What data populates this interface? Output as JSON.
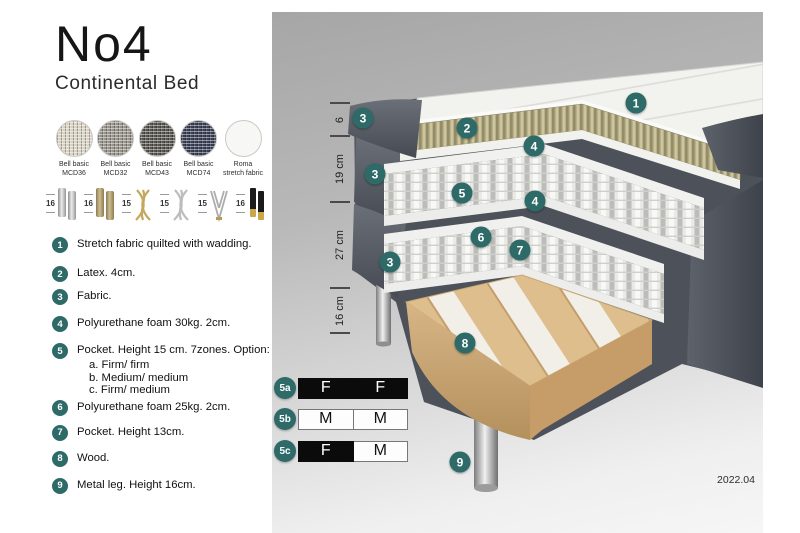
{
  "product": {
    "title": "No4",
    "subtitle": "Continental Bed"
  },
  "fabric_swatches": [
    {
      "line1": "Bell basic",
      "line2": "MCD36",
      "base": "#d8d2c2",
      "type": "woven"
    },
    {
      "line1": "Bell basic",
      "line2": "MCD32",
      "base": "#97938a",
      "type": "woven"
    },
    {
      "line1": "Bell basic",
      "line2": "MCD43",
      "base": "#56544f",
      "type": "woven"
    },
    {
      "line1": "Bell basic",
      "line2": "MCD74",
      "base": "#3a3e54",
      "type": "woven"
    },
    {
      "line1": "Roma",
      "line2": "stretch fabric",
      "base": "#f7f7f5",
      "type": "plain"
    }
  ],
  "leg_options": [
    {
      "height": "16",
      "style": "chrome-cylinder"
    },
    {
      "height": "16",
      "style": "brass-cylinder"
    },
    {
      "height": "15",
      "style": "gold-twisted"
    },
    {
      "height": "15",
      "style": "silver-twisted"
    },
    {
      "height": "15",
      "style": "hairpin"
    },
    {
      "height": "16",
      "style": "black-gold"
    }
  ],
  "spec_list": [
    {
      "num": "1",
      "text": "Stretch fabric quilted with wadding.",
      "options": []
    },
    {
      "num": "2",
      "text": "Latex. 4cm.",
      "options": []
    },
    {
      "num": "3",
      "text": "Fabric.",
      "options": []
    },
    {
      "num": "4",
      "text": "Polyurethane foam 30kg. 2cm.",
      "options": []
    },
    {
      "num": "5",
      "text": "Pocket. Height 15 cm. 7zones. Option:",
      "options": [
        "a. Firm/ firm",
        "b. Medium/ medium",
        "c. Firm/ medium"
      ]
    },
    {
      "num": "6",
      "text": "Polyurethane foam 25kg. 2cm.",
      "options": []
    },
    {
      "num": "7",
      "text": "Pocket. Height 13cm.",
      "options": []
    },
    {
      "num": "8",
      "text": "Wood.",
      "options": []
    },
    {
      "num": "9",
      "text": "Metal leg. Height 16cm.",
      "options": []
    }
  ],
  "diagram": {
    "dimension_segments": [
      {
        "label": "6",
        "from": 91,
        "to": 124
      },
      {
        "label": "19 cm",
        "from": 124,
        "to": 190
      },
      {
        "label": "27 cm",
        "from": 190,
        "to": 276
      },
      {
        "label": "16 cm",
        "from": 276,
        "to": 321
      }
    ],
    "callouts": [
      {
        "label": "1",
        "x": 364,
        "y": 91
      },
      {
        "label": "2",
        "x": 195,
        "y": 116
      },
      {
        "label": "3",
        "x": 91,
        "y": 106
      },
      {
        "label": "4",
        "x": 262,
        "y": 134
      },
      {
        "label": "3",
        "x": 103,
        "y": 162
      },
      {
        "label": "5",
        "x": 190,
        "y": 181
      },
      {
        "label": "4",
        "x": 263,
        "y": 189
      },
      {
        "label": "6",
        "x": 209,
        "y": 225
      },
      {
        "label": "7",
        "x": 248,
        "y": 238
      },
      {
        "label": "3",
        "x": 118,
        "y": 250
      },
      {
        "label": "8",
        "x": 193,
        "y": 331
      },
      {
        "label": "9",
        "x": 188,
        "y": 450
      }
    ],
    "firmness_options": [
      {
        "label": "5a",
        "top": 365,
        "cells": [
          {
            "text": "F",
            "variant": "dark"
          },
          {
            "text": "F",
            "variant": "dark"
          }
        ]
      },
      {
        "label": "5b",
        "top": 396,
        "cells": [
          {
            "text": "M",
            "variant": "light"
          },
          {
            "text": "M",
            "variant": "light"
          }
        ]
      },
      {
        "label": "5c",
        "top": 428,
        "cells": [
          {
            "text": "F",
            "variant": "dark"
          },
          {
            "text": "M",
            "variant": "light"
          }
        ]
      }
    ],
    "version": "2022.04"
  },
  "colors": {
    "teal": "#2e6b68"
  }
}
